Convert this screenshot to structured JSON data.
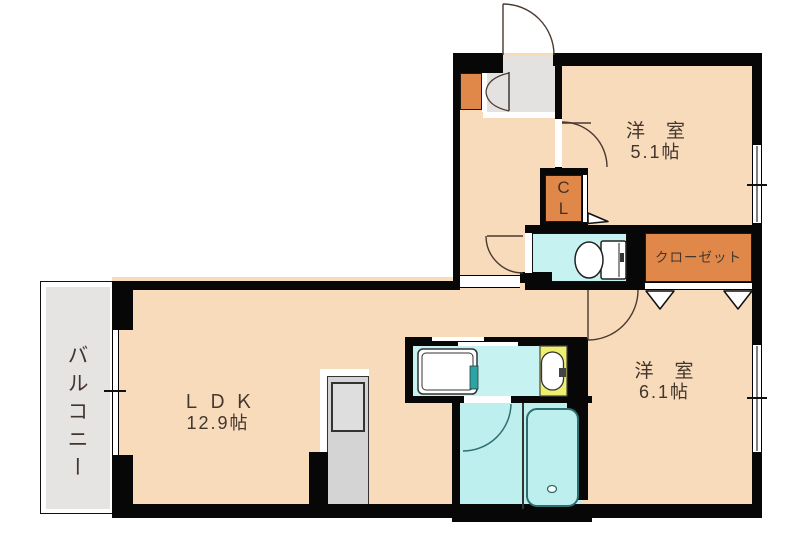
{
  "title": "apartment-floor-plan",
  "rooms": {
    "western1": {
      "name": "洋　室",
      "size": "5.1帖"
    },
    "western2": {
      "name": "洋　室",
      "size": "6.1帖"
    },
    "ldk": {
      "name": "Ｌ Ｄ Ｋ",
      "size": "12.9帖"
    },
    "balcony": {
      "name": "バルコニー"
    },
    "closet": {
      "name": "クローゼット"
    },
    "cl": {
      "line1": "C",
      "line2": "L"
    }
  },
  "fixtures": [
    "toilet",
    "bathtub",
    "washbasin",
    "washing-machine-pan",
    "kitchen-counter-sink",
    "shoe-cabinet",
    "entrance-door",
    "hinged-doors",
    "sliding-door",
    "folding-closet-doors",
    "windows"
  ],
  "colors": {
    "floor": "#F8DBBB",
    "wall": "#070707",
    "water_rooms": "#C6F2F2",
    "bathroom": "#BEEFEF",
    "closet_orange": "#E0874A",
    "basin_yellow": "#EFEF6E",
    "entry_grey": "#E4E1E1",
    "balcony_grey": "#E6E3E3",
    "counter_grey": "#D4D4D4",
    "label_text": "#43362E",
    "bath_line": "#2E6E6E"
  }
}
